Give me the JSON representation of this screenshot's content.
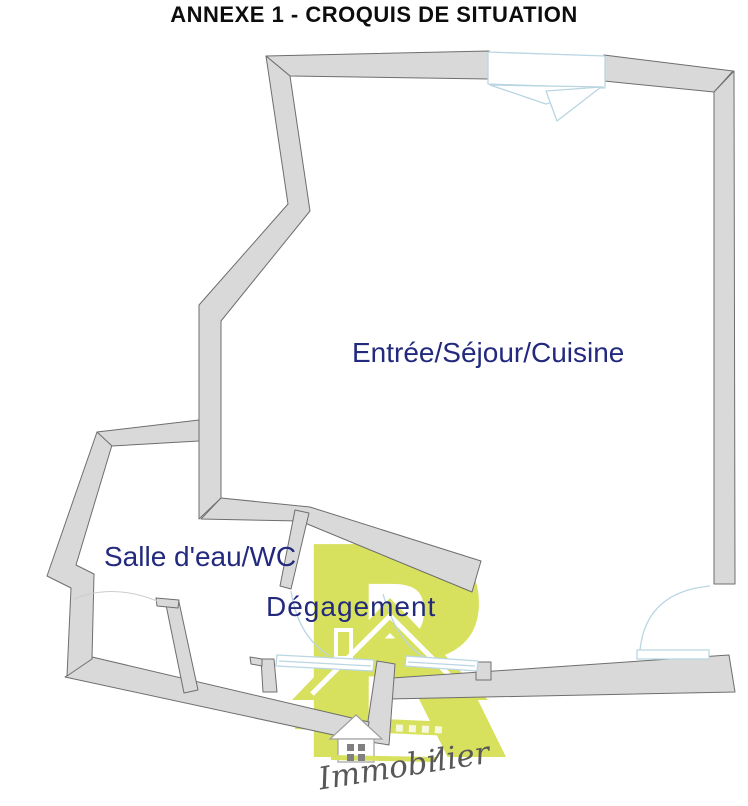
{
  "title": "ANNEXE 1 - CROQUIS DE SITUATION",
  "rooms": {
    "main": {
      "label": "Entrée/Séjour/Cuisine"
    },
    "bathroom": {
      "label": "Salle d'eau/WC"
    },
    "hallway": {
      "label": "Dégagement"
    }
  },
  "watermark": {
    "letter": "R",
    "script": "Immobilier"
  },
  "colors": {
    "title_color": "#0d0d0d",
    "room_label": "#232a7e",
    "wall_fill": "#d9d9d9",
    "wall_stroke": "#6e6e6e",
    "opening_stroke": "#b9d6e2",
    "watermark_green": "#d7e15e",
    "watermark_text": "#585858"
  }
}
